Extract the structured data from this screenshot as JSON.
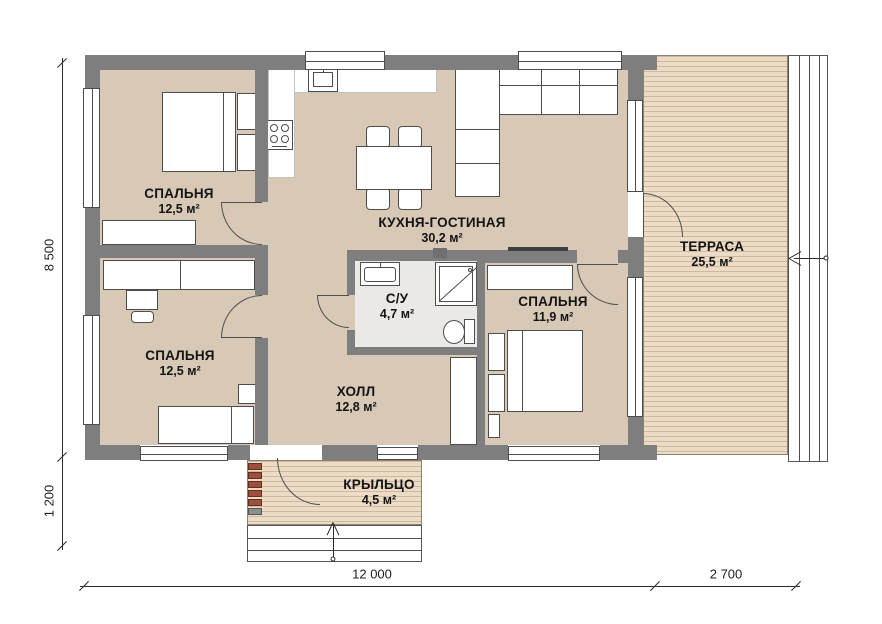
{
  "rooms": {
    "bedroom_top_left": {
      "name": "СПАЛЬНЯ",
      "area": "12,5 м²"
    },
    "kitchen_living": {
      "name": "КУХНЯ-ГОСТИНАЯ",
      "area": "30,2 м²"
    },
    "terrace": {
      "name": "ТЕРРАСА",
      "area": "25,5 м²"
    },
    "bathroom": {
      "name": "С/У",
      "area": "4,7 м²"
    },
    "bedroom_right": {
      "name": "СПАЛЬНЯ",
      "area": "11,9 м²"
    },
    "bedroom_bottom_left": {
      "name": "СПАЛЬНЯ",
      "area": "12,5 м²"
    },
    "hall": {
      "name": "ХОЛЛ",
      "area": "12,8 м²"
    },
    "porch": {
      "name": "КРЫЛЬЦО",
      "area": "4,5 м²"
    }
  },
  "dimensions": {
    "height_main": "8 500",
    "height_porch": "1 200",
    "width_main": "12 000",
    "width_terrace": "2 700"
  },
  "colors": {
    "wall": "#7e7e7e",
    "floor": "#d7c9b6",
    "deck": "#ecdcc5",
    "bath_floor": "#ebe9e5",
    "ladder_accent": "#9c4f3c"
  }
}
